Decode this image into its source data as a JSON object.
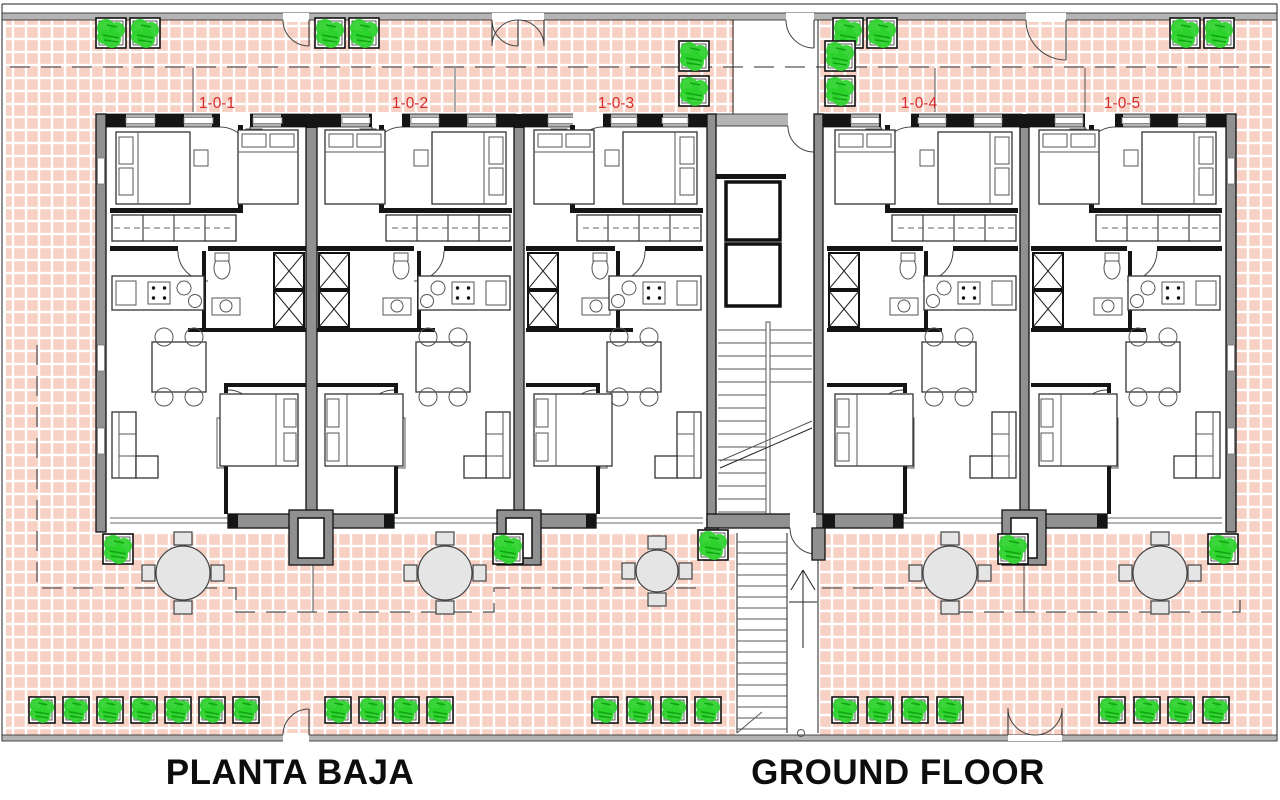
{
  "captions": {
    "left": "PLANTA BAJA",
    "right": "GROUND FLOOR"
  },
  "unit_labels": [
    {
      "text": "1-0-1",
      "x": 217
    },
    {
      "text": "1-0-2",
      "x": 410
    },
    {
      "text": "1-0-3",
      "x": 616
    },
    {
      "text": "1-0-4",
      "x": 919
    },
    {
      "text": "1-0-5",
      "x": 1122
    }
  ],
  "label_y": 108,
  "units": [
    {
      "id": "1-0-1",
      "x": 106,
      "w": 204,
      "mirrored": false
    },
    {
      "id": "1-0-2",
      "x": 313,
      "w": 203,
      "mirrored": true
    },
    {
      "id": "1-0-3",
      "x": 522,
      "w": 185,
      "mirrored": true
    },
    {
      "id": "1-0-4",
      "x": 823,
      "w": 199,
      "mirrored": true
    },
    {
      "id": "1-0-5",
      "x": 1027,
      "w": 199,
      "mirrored": true
    }
  ],
  "plants": {
    "size_large": 30,
    "size_small": 26,
    "items": [
      [
        111,
        33,
        30
      ],
      [
        145,
        33,
        30
      ],
      [
        330,
        33,
        30
      ],
      [
        364,
        33,
        30
      ],
      [
        848,
        33,
        30
      ],
      [
        882,
        33,
        30
      ],
      [
        1185,
        33,
        30
      ],
      [
        1219,
        33,
        30
      ],
      [
        694,
        56,
        30
      ],
      [
        694,
        91,
        30
      ],
      [
        840,
        56,
        30
      ],
      [
        840,
        91,
        30
      ],
      [
        118,
        549,
        30
      ],
      [
        508,
        549,
        30
      ],
      [
        713,
        545,
        30
      ],
      [
        1013,
        549,
        30
      ],
      [
        1223,
        549,
        30
      ],
      [
        42,
        710,
        26
      ],
      [
        76,
        710,
        26
      ],
      [
        110,
        710,
        26
      ],
      [
        144,
        710,
        26
      ],
      [
        178,
        710,
        26
      ],
      [
        212,
        710,
        26
      ],
      [
        246,
        710,
        26
      ],
      [
        338,
        710,
        26
      ],
      [
        372,
        710,
        26
      ],
      [
        406,
        710,
        26
      ],
      [
        440,
        710,
        26
      ],
      [
        605,
        710,
        26
      ],
      [
        640,
        710,
        26
      ],
      [
        674,
        710,
        26
      ],
      [
        708,
        710,
        26
      ],
      [
        845,
        710,
        26
      ],
      [
        880,
        710,
        26
      ],
      [
        915,
        710,
        26
      ],
      [
        950,
        710,
        26
      ],
      [
        1112,
        710,
        26
      ],
      [
        1147,
        710,
        26
      ],
      [
        1181,
        710,
        26
      ],
      [
        1216,
        710,
        26
      ]
    ]
  },
  "tables": [
    [
      183,
      573,
      27
    ],
    [
      445,
      573,
      27
    ],
    [
      657,
      571,
      21
    ],
    [
      950,
      573,
      27
    ],
    [
      1160,
      573,
      27
    ]
  ],
  "gates": {
    "top": [
      {
        "x": 283,
        "w": 26,
        "double": false
      },
      {
        "x": 492,
        "w": 52,
        "double": true
      },
      {
        "x": 786,
        "w": 28,
        "double": false
      },
      {
        "x": 1026,
        "w": 40,
        "double": false
      }
    ],
    "bottom": [
      {
        "x": 283,
        "w": 26,
        "double": false
      },
      {
        "x": 1008,
        "w": 54,
        "double": true
      }
    ]
  },
  "colors": {
    "tile": "#f8d1c5",
    "grout": "#ffffff",
    "wall_dark": "#151515",
    "wall_gray": "#909090",
    "plant_green": "#2bd22b",
    "plant_green_dark": "#11a511",
    "label_red": "#d92b2b",
    "table_gray": "#e5e5e5"
  }
}
